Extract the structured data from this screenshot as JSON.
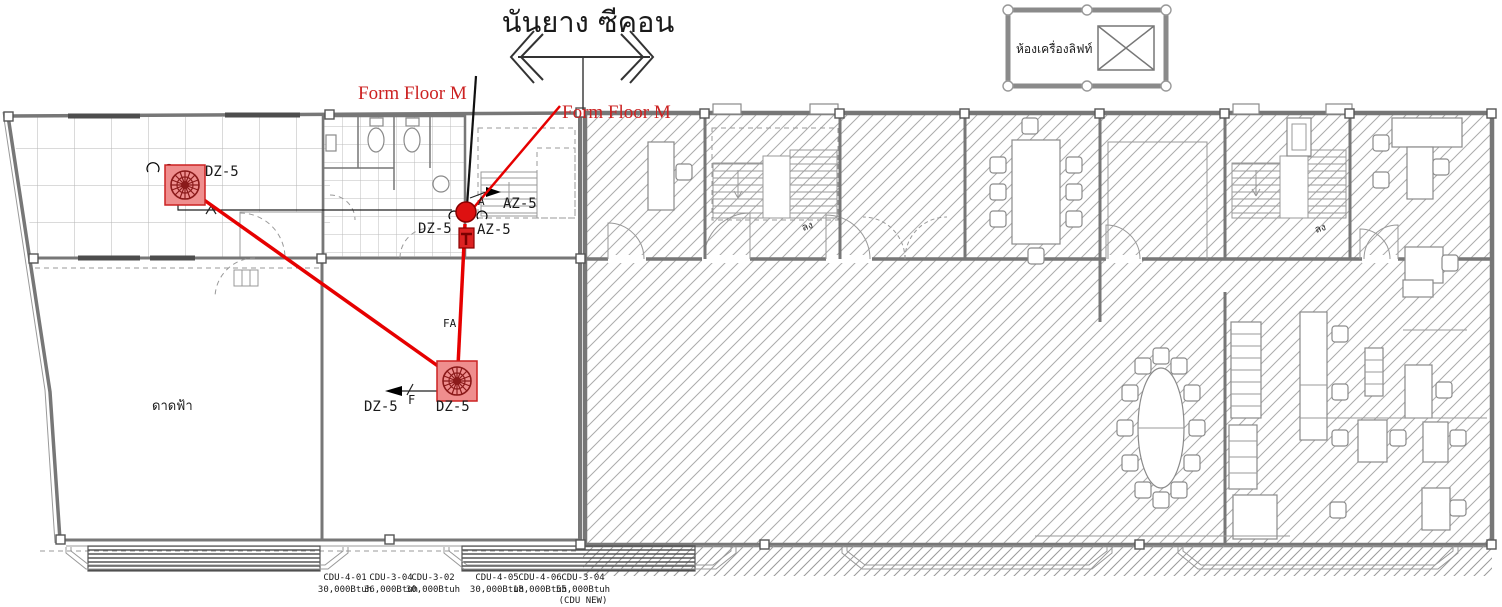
{
  "title": {
    "text": "นันยาง  ซีคอน"
  },
  "annotations": {
    "form_floor_label_1": "Form Floor M",
    "form_floor_label_2": "Form Floor M"
  },
  "legend": {
    "label": "ห้องเครื่องลิฟท์"
  },
  "rooms": {
    "terrace_label": "ดาดฟ้า",
    "stair_down_label_1": "ลง",
    "stair_down_label_2": "ลง"
  },
  "hvac": {
    "fan1_label": "DZ-5",
    "unit_label": "DZ-5",
    "az_label_top": "AZ-5",
    "az_label_bottom": "AZ-5",
    "duct_a": "A",
    "duct_fa": "FA",
    "duct_f": "F",
    "fan2_label_left": "DZ-5",
    "fan2_label_right": "DZ-5"
  },
  "cdu_units": [
    {
      "name": "CDU-4-01",
      "capacity": "30,000Btuh",
      "note": ""
    },
    {
      "name": "CDU-3-04",
      "capacity": "36,000Btuh",
      "note": ""
    },
    {
      "name": "CDU-3-02",
      "capacity": "30,000Btuh",
      "note": ""
    },
    {
      "name": "CDU-4-05",
      "capacity": "30,000Btuh",
      "note": ""
    },
    {
      "name": "CDU-4-06",
      "capacity": "18,000Btuh",
      "note": ""
    },
    {
      "name": "CDU-3-04",
      "capacity": "55,000Btuh",
      "note": "(CDU NEW)"
    }
  ],
  "colors": {
    "accent_red": "#e60000",
    "wall_gray": "#777777",
    "hatch_gray": "#ababab",
    "label_red": "#cc2222"
  }
}
